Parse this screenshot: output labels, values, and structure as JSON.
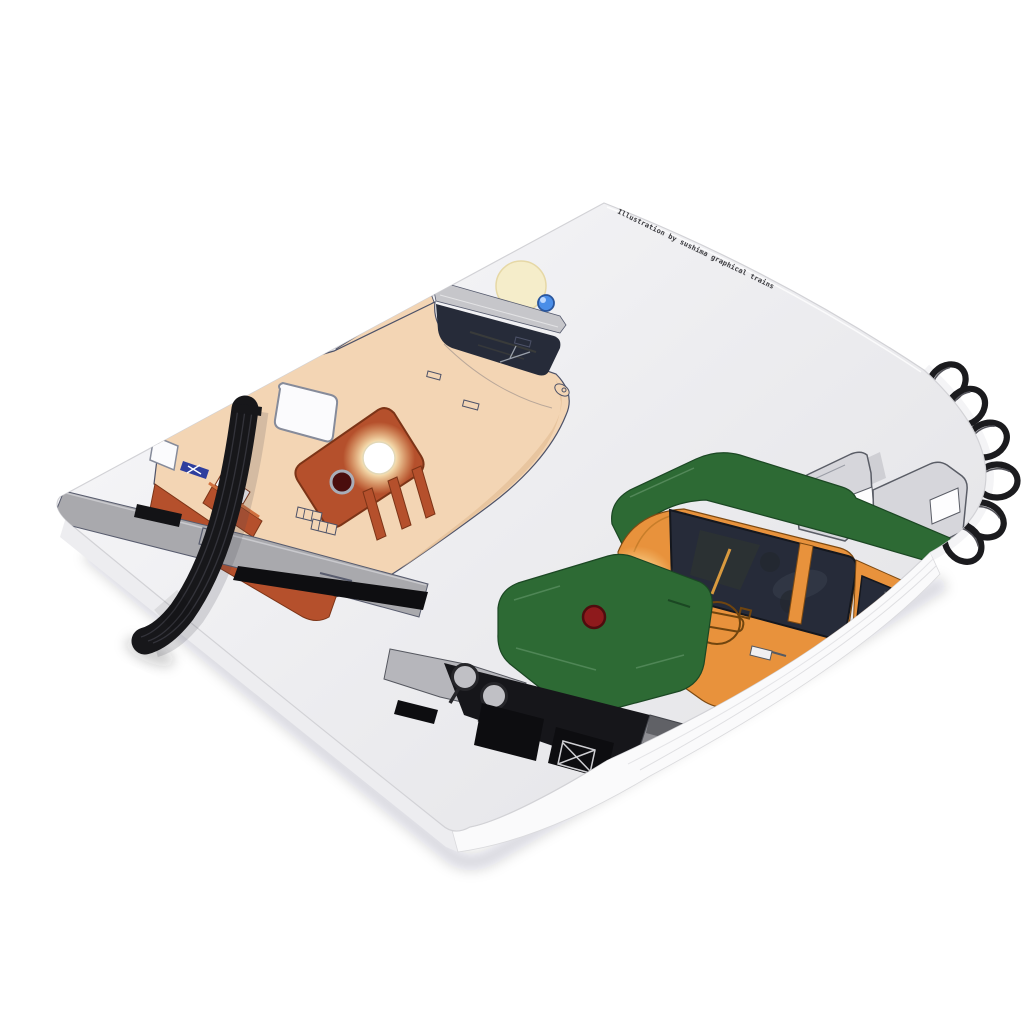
{
  "credit": {
    "text": "Illustration by sushima graphical trains"
  },
  "colors": {
    "background": "#ffffff",
    "cover": "#efeff2",
    "cover_shade": "#e7e7ea",
    "page_edge": "#fafafb",
    "ring": "#1b1b1e",
    "band": "#17171a",
    "cream_body": "#f3d5b4",
    "vermilion": "#b5502c",
    "green": "#2d6a34",
    "orange": "#e8923c",
    "window_dark": "#262b39",
    "skirt_gray": "#a9a9ad",
    "ghost_gray": "#d6d6db",
    "taillight_red": "#8e1a1c",
    "marker_blue": "#4a8ee8",
    "moon": "#f5edca",
    "headlight_glow": "#fff3c4"
  }
}
